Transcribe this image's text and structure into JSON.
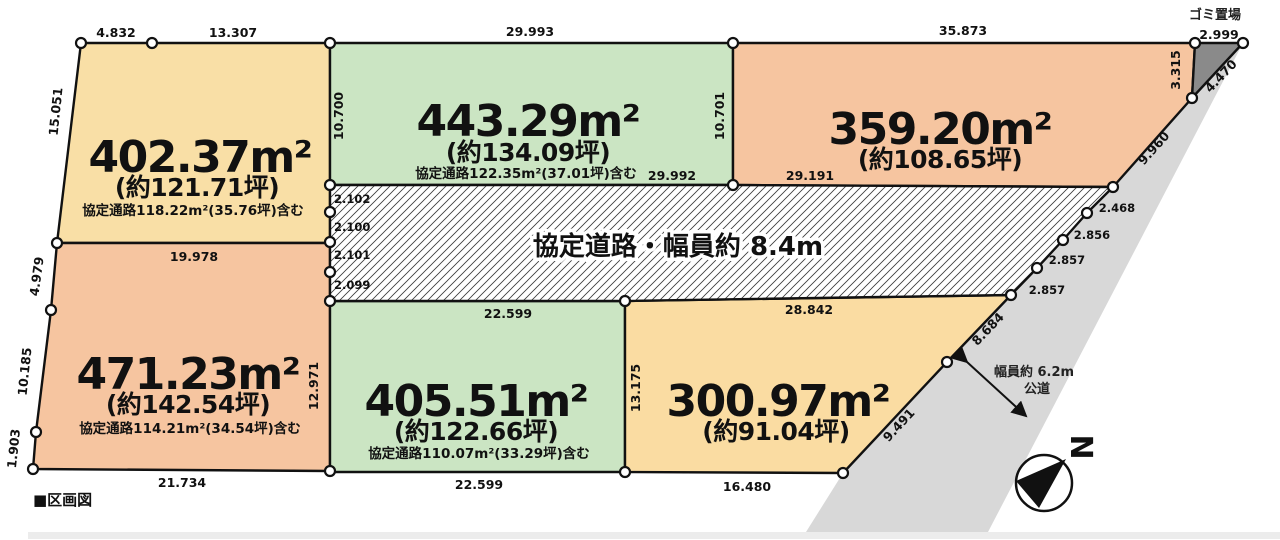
{
  "legend": {
    "label": "■区画図"
  },
  "garbage_area": {
    "label": "ゴミ置場"
  },
  "agreement_road": {
    "label": "協定道路・幅員約 8.4m"
  },
  "public_road": {
    "line1": "幅員約 6.2m",
    "line2": "公道"
  },
  "compass": {
    "north_label": "N"
  },
  "colors": {
    "cream": "#F9DFA6",
    "green": "#CBE5C3",
    "salmon": "#F6C5A0",
    "cream2": "#FADCA2",
    "road_grey": "#D8D8D8",
    "garbage_grey": "#8A8A8A",
    "strip_grey": "#ECECEC",
    "line": "#111111"
  },
  "parcels": [
    {
      "name": "top-left",
      "area": "402.37m²",
      "tsubo": "(約121.71坪)",
      "note": "協定通路118.22m²(35.76坪)含む",
      "color": "#F9DFA6"
    },
    {
      "name": "top-middle",
      "area": "443.29m²",
      "tsubo": "(約134.09坪)",
      "note": "協定通路122.35m²(37.01坪)含む",
      "color": "#CBE5C3"
    },
    {
      "name": "top-right",
      "area": "359.20m²",
      "tsubo": "(約108.65坪)",
      "note": "",
      "color": "#F6C5A0"
    },
    {
      "name": "bottom-left",
      "area": "471.23m²",
      "tsubo": "(約142.54坪)",
      "note": "協定通路114.21m²(34.54坪)含む",
      "color": "#F6C5A0"
    },
    {
      "name": "bottom-middle",
      "area": "405.51m²",
      "tsubo": "(約122.66坪)",
      "note": "協定通路110.07m²(33.29坪)含む",
      "color": "#CBE5C3"
    },
    {
      "name": "bottom-right",
      "area": "300.97m²",
      "tsubo": "(約91.04坪)",
      "note": "",
      "color": "#FADCA2"
    }
  ],
  "dims": {
    "p1_top_a": "4.832",
    "p1_top_b": "13.307",
    "p1_left": "15.051",
    "p2_top": "29.993",
    "p2_left": "10.700",
    "p2_right": "10.701",
    "p2_bottom": "29.992",
    "p3_top": "35.873",
    "p3_bottom": "29.191",
    "p4_top": "19.978",
    "p4_left_a": "4.979",
    "p4_left_b": "10.185",
    "p4_left_c": "1.903",
    "p4_bottom": "21.734",
    "p4_right": "12.971",
    "p5_top": "22.599",
    "p5_bottom": "22.599",
    "p5_right": "13.175",
    "p6_top": "28.842",
    "p6_bottom": "16.480",
    "road_w1": "2.102",
    "road_w2": "2.100",
    "road_w3": "2.101",
    "road_w4": "2.099",
    "g_top": "2.999",
    "g_left": "3.315",
    "g_diag": "4.470",
    "d_9960": "9.960",
    "d_2468": "2.468",
    "d_2856": "2.856",
    "d_2857a": "2.857",
    "d_2857b": "2.857",
    "d_8684": "8.684",
    "d_9491": "9.491"
  }
}
